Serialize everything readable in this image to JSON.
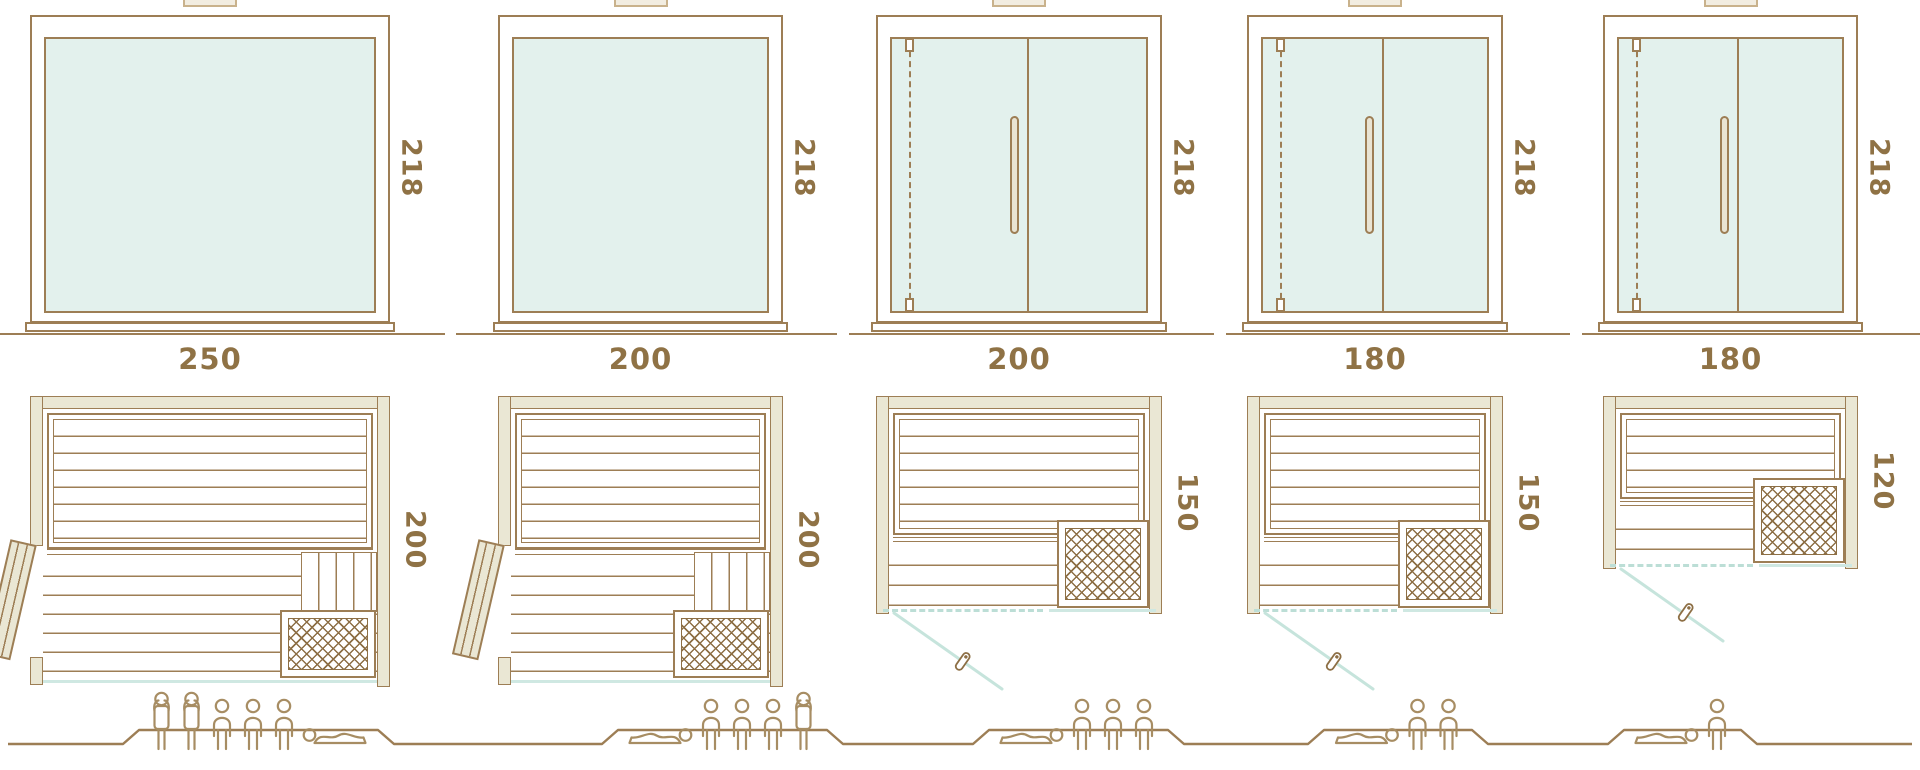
{
  "colors": {
    "line_brown": "#9d7e55",
    "label_text": "#8f7245",
    "glass_fill": "#e3f1ed",
    "glass_line_teal": "#cfe8e2",
    "wall_fill": "#eae7d4",
    "lattice_brown": "#8d6f45",
    "people_outline": "#a78d63"
  },
  "units": [
    {
      "name": "sauna-variant-1",
      "front": {
        "width": "250",
        "height": "218",
        "style": "full glass front, no door divider"
      },
      "plan": {
        "depth": "200",
        "door": "wooden hinged door, left side, shown open",
        "heater": "bottom-right lattice grille",
        "benches": "upper bench + lower bench slats"
      },
      "capacity": 6,
      "people": [
        "standing",
        "standing",
        "sitting",
        "sitting",
        "sitting",
        "lying-right"
      ]
    },
    {
      "name": "sauna-variant-2",
      "front": {
        "width": "200",
        "height": "218",
        "style": "full glass front, no door divider"
      },
      "plan": {
        "depth": "200",
        "door": "wooden hinged door, left side, shown open",
        "heater": "bottom-right lattice grille",
        "benches": "upper bench + lower bench slats"
      },
      "capacity": 5,
      "people": [
        "lying-left",
        "sitting",
        "sitting",
        "sitting",
        "standing"
      ]
    },
    {
      "name": "sauna-variant-3",
      "front": {
        "width": "200",
        "height": "218",
        "style": "glass front with hinged glass door and vertical handle"
      },
      "plan": {
        "depth": "150",
        "door": "glass door swinging outward, dashed closed position",
        "heater": "bottom-right lattice grille",
        "benches": "upper bench + lower bench slats"
      },
      "capacity": 4,
      "people": [
        "lying-left",
        "sitting",
        "sitting",
        "sitting"
      ]
    },
    {
      "name": "sauna-variant-4",
      "front": {
        "width": "180",
        "height": "218",
        "style": "glass front with hinged glass door and vertical handle"
      },
      "plan": {
        "depth": "150",
        "door": "glass door swinging outward, dashed closed position",
        "heater": "bottom-right lattice grille",
        "benches": "upper bench + lower bench slats"
      },
      "capacity": 3,
      "people": [
        "lying-left",
        "sitting",
        "sitting"
      ]
    },
    {
      "name": "sauna-variant-5",
      "front": {
        "width": "180",
        "height": "218",
        "style": "glass front with hinged glass door and vertical handle"
      },
      "plan": {
        "depth": "120",
        "door": "glass door swinging outward, dashed closed position",
        "heater": "right side lattice grille",
        "benches": "upper bench + lower bench slats"
      },
      "capacity": 2,
      "people": [
        "lying-left",
        "sitting"
      ]
    }
  ]
}
